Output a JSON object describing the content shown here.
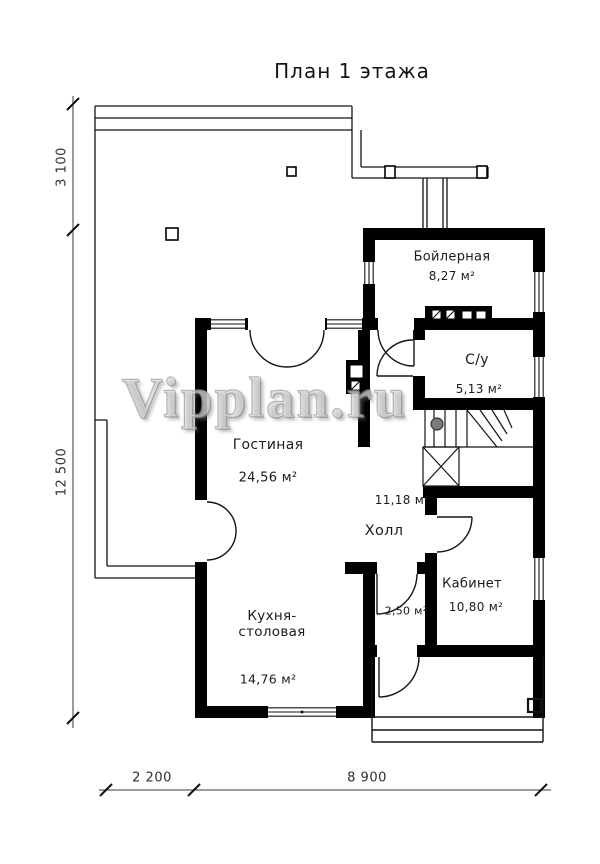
{
  "title": "План 1 этажа",
  "watermark": "Vipplan.ru",
  "rooms": {
    "boiler": {
      "name": "Бойлерная",
      "area": "8,27 м²"
    },
    "bathroom": {
      "name": "С/у",
      "area": "5,13 м²"
    },
    "living": {
      "name": "Гостиная",
      "area": "24,56 м²"
    },
    "hall": {
      "name": "Холл",
      "area": "11,18 м²"
    },
    "office": {
      "name": "Кабинет",
      "area": "10,80 м²"
    },
    "vestibule": {
      "area": "2,50 м²"
    },
    "kitchen": {
      "name_line1": "Кухня-",
      "name_line2": "столовая",
      "area": "14,76 м²"
    }
  },
  "dimensions": {
    "left_top": "3 100",
    "left_main": "12 500",
    "bottom_left": "2 200",
    "bottom_main": "8 900"
  },
  "colors": {
    "wall": "#000000",
    "line": "#141414",
    "dimension": "#333333",
    "newel_post": "#7a7a7a",
    "background": "#ffffff"
  }
}
